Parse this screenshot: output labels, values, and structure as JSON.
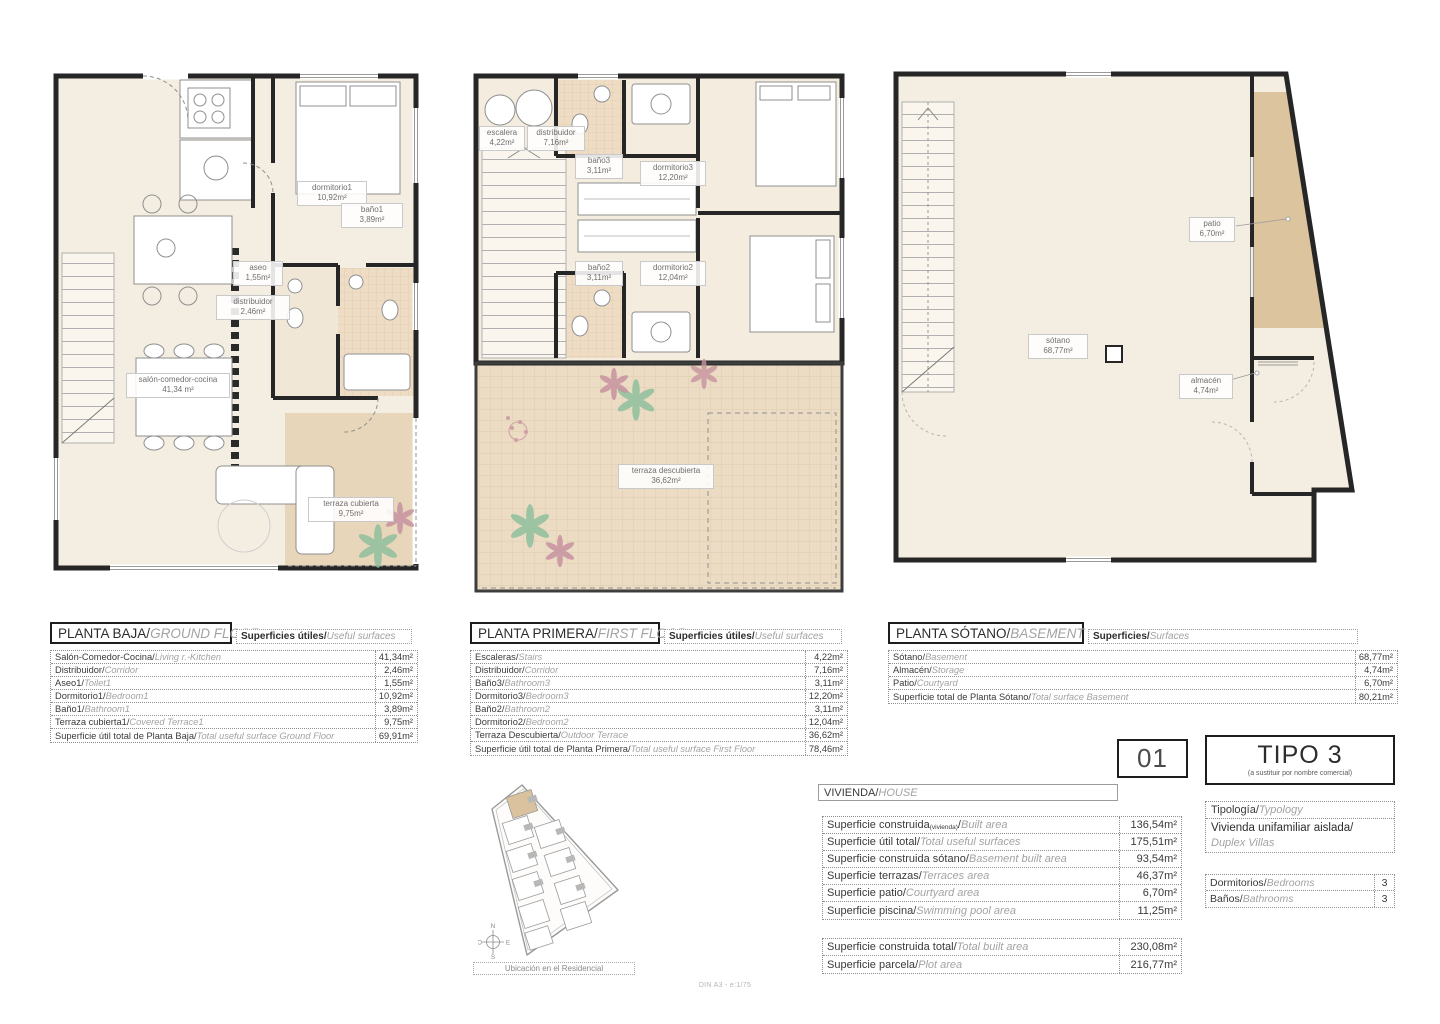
{
  "palette": {
    "floor_cream": "#f4ede1",
    "terrace_tan": "#e8d6ba",
    "patio_tan": "#dcc49e",
    "tile": "#eedcc4",
    "wall": "#262626",
    "plant_green": "#8fbf9d",
    "plant_pink": "#c793a0"
  },
  "plans": {
    "ground": {
      "title_es": "PLANTA BAJA",
      "title_en": "GROUND FLOOR",
      "surf_es": "Superficies útiles",
      "surf_en": "Useful surfaces",
      "labels": {
        "dormitorio1": {
          "name": "dormitorio1",
          "area": "10,92m²"
        },
        "bano1": {
          "name": "baño1",
          "area": "3,89m²"
        },
        "aseo": {
          "name": "aseo",
          "area": "1,55m²"
        },
        "distribuidor": {
          "name": "distribuidor",
          "area": "2,46m²"
        },
        "salon": {
          "name": "salón-comedor-cocina",
          "area": "41,34 m²"
        },
        "terraza": {
          "name": "terraza cubierta",
          "area": "9,75m²"
        }
      },
      "rows": [
        {
          "es": "Salón-Comedor-Cocina",
          "en": "Living r.-Kitchen",
          "value": "41,34m²"
        },
        {
          "es": "Distribuidor",
          "en": "Corridor",
          "value": "2,46m²"
        },
        {
          "es": "Aseo1",
          "en": "Toilet1",
          "value": "1,55m²"
        },
        {
          "es": "Dormitorio1",
          "en": "Bedroom1",
          "value": "10,92m²"
        },
        {
          "es": "Baño1",
          "en": "Bathroom1",
          "value": "3,89m²"
        },
        {
          "es": "Terraza cubierta1",
          "en": "Covered Terrace1",
          "value": "9,75m²"
        },
        {
          "es": "Superficie útil total de Planta Baja",
          "en": "Total useful surface Ground Floor",
          "value": "69,91m²"
        }
      ]
    },
    "first": {
      "title_es": "PLANTA PRIMERA",
      "title_en": "FIRST FLOOR",
      "surf_es": "Superficies útiles",
      "surf_en": "Useful surfaces",
      "labels": {
        "escalera": {
          "name": "escalera",
          "area": "4,22m²"
        },
        "distribuidor": {
          "name": "distribuidor",
          "area": "7,16m²"
        },
        "bano3": {
          "name": "baño3",
          "area": "3,11m²"
        },
        "dormitorio3": {
          "name": "dormitorio3",
          "area": "12,20m²"
        },
        "bano2": {
          "name": "baño2",
          "area": "3,11m²"
        },
        "dormitorio2": {
          "name": "dormitorio2",
          "area": "12,04m²"
        },
        "terraza": {
          "name": "terraza descubierta",
          "area": "36,62m²"
        }
      },
      "rows": [
        {
          "es": "Escaleras",
          "en": "Stairs",
          "value": "4,22m²"
        },
        {
          "es": "Distribuidor",
          "en": "Corridor",
          "value": "7,16m²"
        },
        {
          "es": "Baño3",
          "en": "Bathroom3",
          "value": "3,11m²"
        },
        {
          "es": "Dormitorio3",
          "en": "Bedroom3",
          "value": "12,20m²"
        },
        {
          "es": "Baño2",
          "en": "Bathroom2",
          "value": "3,11m²"
        },
        {
          "es": "Dormitorio2",
          "en": "Bedroom2",
          "value": "12,04m²"
        },
        {
          "es": "Terraza Descubierta",
          "en": "Outdoor Terrace",
          "value": "36,62m²"
        },
        {
          "es": "Superficie útil total de Planta Primera",
          "en": "Total useful surface First Floor",
          "value": "78,46m²"
        }
      ]
    },
    "basement": {
      "title_es": "PLANTA SÓTANO",
      "title_en": "BASEMENT",
      "surf_es": "Superficies",
      "surf_en": "Surfaces",
      "labels": {
        "patio": {
          "name": "patio",
          "area": "6,70m²"
        },
        "sotano": {
          "name": "sótano",
          "area": "68,77m²"
        },
        "almacen": {
          "name": "almacén",
          "area": "4,74m²"
        }
      },
      "rows": [
        {
          "es": "Sótano",
          "en": "Basement",
          "value": "68,77m²"
        },
        {
          "es": "Almacén",
          "en": "Storage",
          "value": "4,74m²"
        },
        {
          "es": "Patio",
          "en": "Courtyard",
          "value": "6,70m²"
        },
        {
          "es": "Superficie total de Planta Sótano",
          "en": "Total surface Basement",
          "value": "80,21m²"
        }
      ]
    }
  },
  "vivienda": {
    "header_es": "VIVIENDA",
    "header_en": "HOUSE",
    "rows": [
      {
        "es": "Superficie construida",
        "sub": "(vivienda)",
        "en": "Built area",
        "value": "136,54m²"
      },
      {
        "es": "Superficie útil total",
        "en": "Total useful surfaces",
        "value": "175,51m²"
      },
      {
        "es": "Superficie construida sótano",
        "en": "Basement built area",
        "value": "93,54m²"
      },
      {
        "es": "Superficie terrazas",
        "en": "Terraces area",
        "value": "46,37m²"
      },
      {
        "es": "Superficie patio",
        "en": "Courtyard area",
        "value": "6,70m²"
      },
      {
        "es": "Superficie piscina",
        "en": "Swimming pool area",
        "value": "11,25m²"
      }
    ],
    "totals": [
      {
        "es": "Superficie construida total",
        "en": "Total built area",
        "value": "230,08m²"
      },
      {
        "es": "Superficie parcela",
        "en": "Plot area",
        "value": "216,77m²"
      }
    ]
  },
  "unit": {
    "number": "01"
  },
  "tipo": {
    "name": "TIPO 3",
    "note": "(a sustituir por nombre comercial)"
  },
  "typology": {
    "header_es": "Tipología",
    "header_en": "Typology",
    "value_es": "Vivienda unifamiliar aislada",
    "value_en": "Duplex Villas"
  },
  "counts": {
    "rows": [
      {
        "es": "Dormitorios",
        "en": "Bedrooms",
        "value": "3"
      },
      {
        "es": "Baños",
        "en": "Bathrooms",
        "value": "3"
      }
    ]
  },
  "location": {
    "caption": "Ubicación en el Residencial",
    "compass": {
      "n": "N",
      "e": "E",
      "s": "S",
      "o": "O"
    }
  },
  "footer": {
    "scale_note": "DIN A3 - e:1/75"
  }
}
